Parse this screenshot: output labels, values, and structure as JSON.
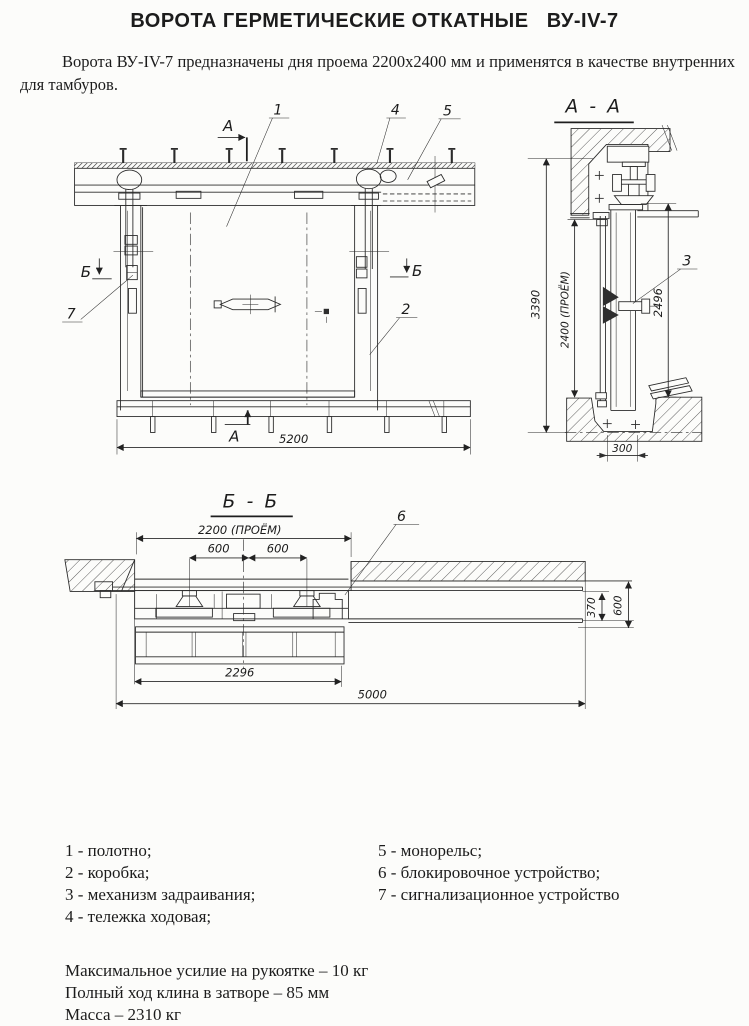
{
  "title": "ВОРОТА ГЕРМЕТИЧЕСКИЕ ОТКАТНЫЕ   ВУ-IV-7",
  "intro": "Ворота ВУ-IV-7 предназначены дня проема 2200х2400 мм и применятся в качестве внутренних для тамбуров.",
  "front_view": {
    "section_a": "А",
    "section_b": "Б",
    "dim_width": "5200",
    "callout_1": "1",
    "callout_2": "2",
    "callout_4": "4",
    "callout_5": "5",
    "callout_7": "7"
  },
  "section_aa": {
    "title": "А - А",
    "callout_3": "3",
    "dim_height_total": "3390",
    "dim_opening": "2400 (ПРОЁМ)",
    "dim_leaf_height": "2496",
    "dim_threshold": "300"
  },
  "section_bb": {
    "title": "Б - Б",
    "callout_6": "6",
    "dim_opening": "2200 (ПРОЁМ)",
    "dim_600_left": "600",
    "dim_600_right": "600",
    "dim_leaf_width": "2296",
    "dim_total_width": "5000",
    "dim_rail_width": "370",
    "dim_wall_offset": "600"
  },
  "legend": {
    "left": [
      "1 - полотно;",
      "2 - коробка;",
      "3 - механизм задраивания;",
      "4 - тележка ходовая;"
    ],
    "right": [
      "5 - монорельс;",
      "6 - блокировочное устройство;",
      "7 - сигнализационное устройство"
    ]
  },
  "specs": [
    "Максимальное усилие на рукоятке – 10 кг",
    "Полный ход клина в затворе – 85 мм",
    "Масса – 2310 кг"
  ]
}
